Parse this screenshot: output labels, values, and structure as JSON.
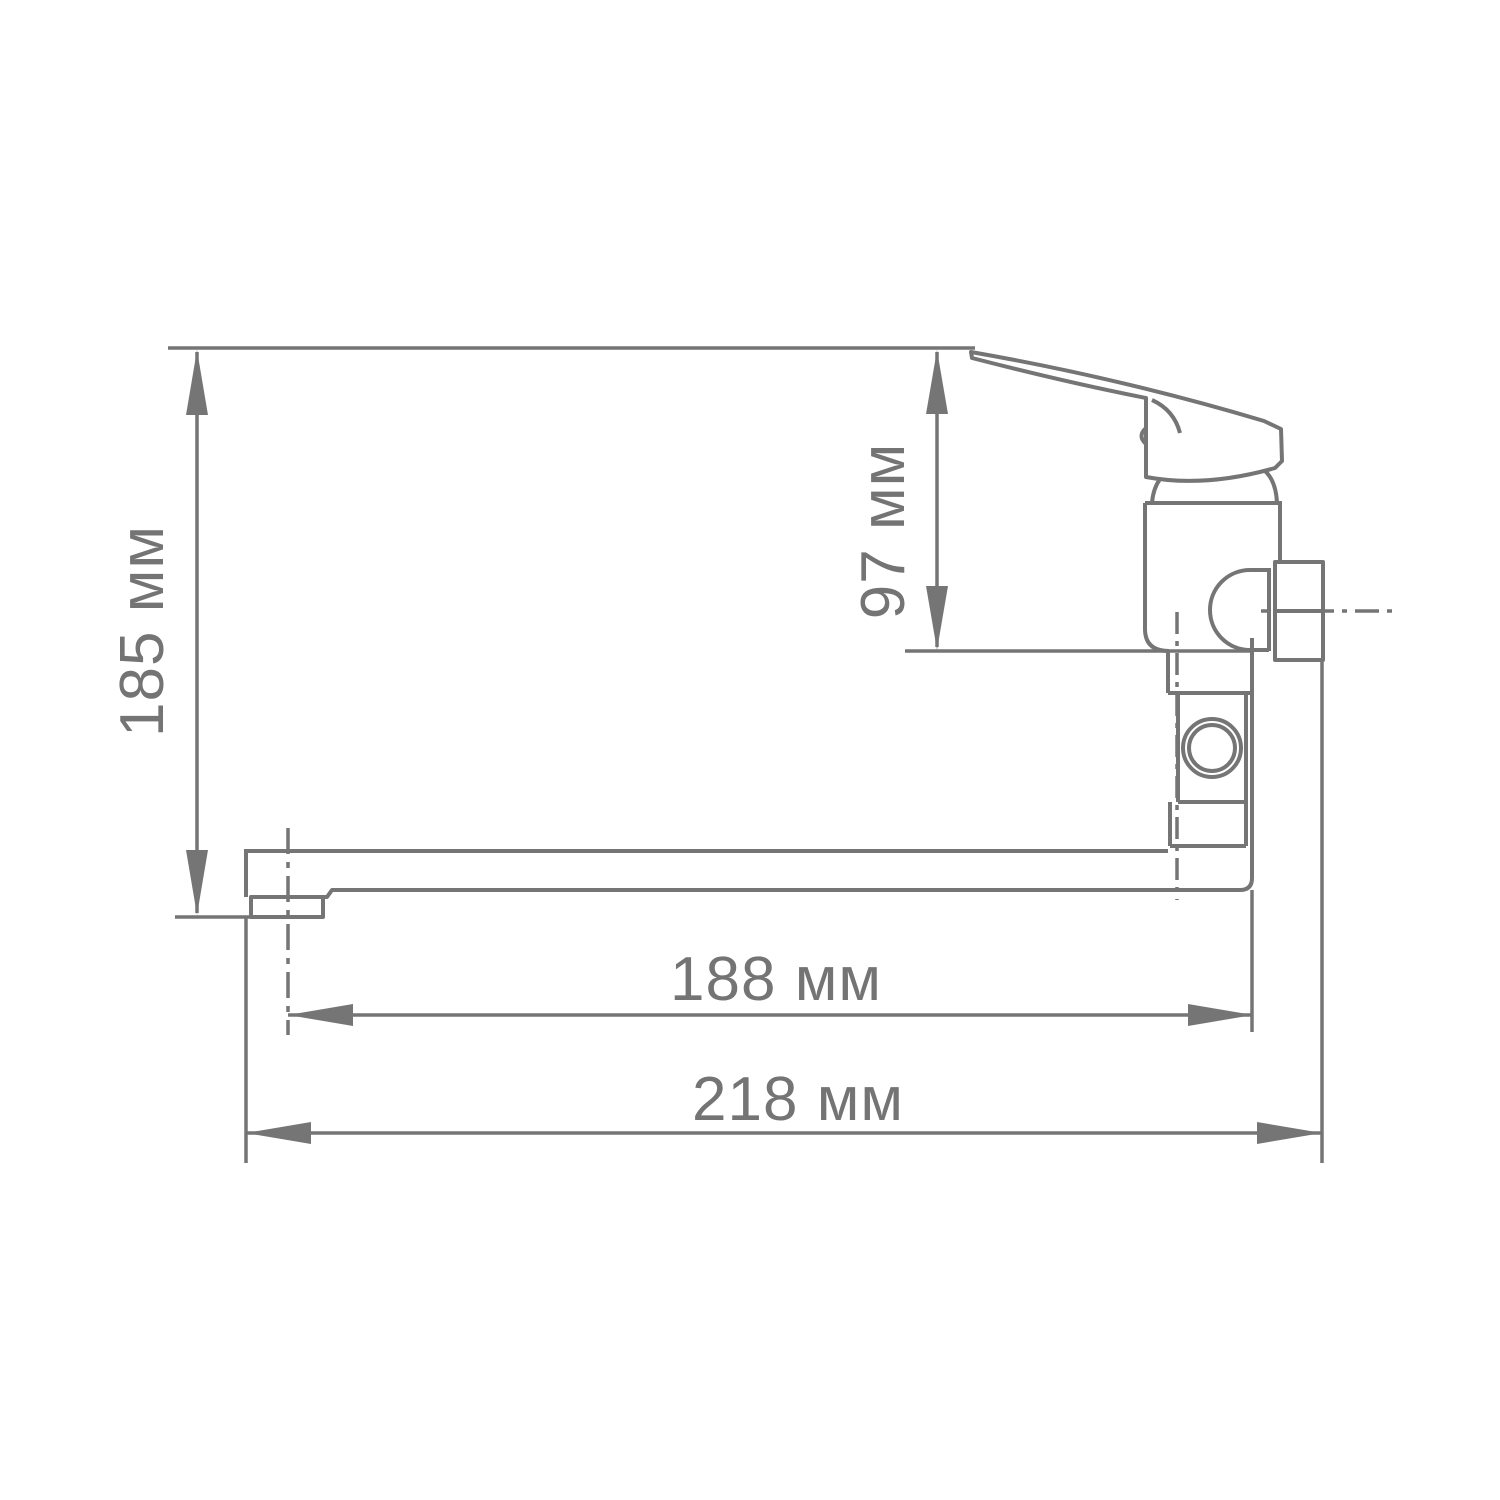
{
  "canvas": {
    "width": 1500,
    "height": 1500,
    "background": "#ffffff"
  },
  "style": {
    "line_color": "#757575",
    "text_color": "#747474"
  },
  "dimensions": {
    "total_height": {
      "label": "185 мм",
      "orientation": "vertical"
    },
    "body_height": {
      "label": "97 мм",
      "orientation": "vertical"
    },
    "spout_reach": {
      "label": "188 мм",
      "orientation": "horizontal"
    },
    "overall_length": {
      "label": "218 мм",
      "orientation": "horizontal"
    }
  }
}
